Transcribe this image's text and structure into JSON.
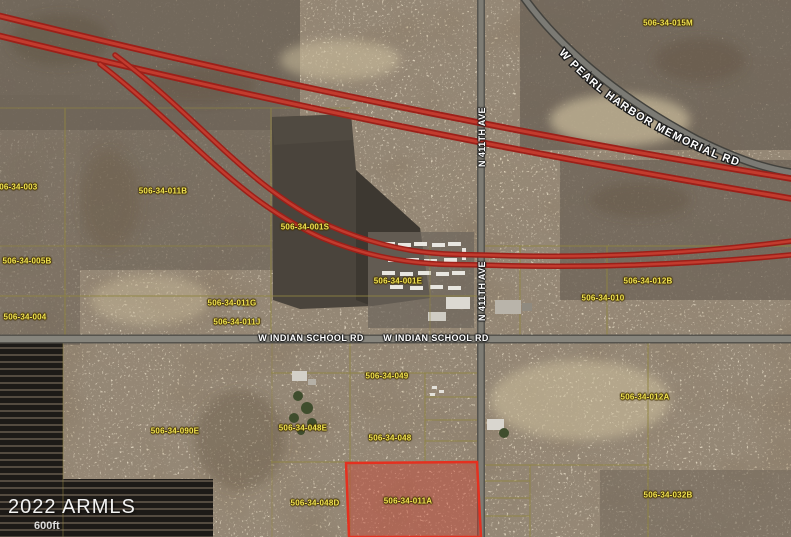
{
  "map": {
    "watermark": "2022 ARMLS",
    "scale_label": "600ft",
    "road_labels": {
      "pearl_harbor": "W PEARL HARBOR MEMORIAL RD",
      "n411_upper": "N 411TH AVE",
      "n411_lower": "N 411TH AVE",
      "indian_school_left": "W INDIAN SCHOOL RD",
      "indian_school_right": "W INDIAN SCHOOL RD"
    },
    "highlight_parcel": {
      "apn": "506-34-011A",
      "outline_color": "#e5301f",
      "fill_color": "#cf4030"
    },
    "parcel_labels": [
      {
        "apn": "506-34-015M"
      },
      {
        "apn": "506-34-003"
      },
      {
        "apn": "506-34-011B"
      },
      {
        "apn": "506-34-001S"
      },
      {
        "apn": "506-34-005B"
      },
      {
        "apn": "506-34-001E"
      },
      {
        "apn": "506-34-011G"
      },
      {
        "apn": "506-34-012B"
      },
      {
        "apn": "506-34-010"
      },
      {
        "apn": "506-34-004"
      },
      {
        "apn": "506-34-011J"
      },
      {
        "apn": "506-34-049"
      },
      {
        "apn": "506-34-012A"
      },
      {
        "apn": "506-34-090E"
      },
      {
        "apn": "506-34-048E"
      },
      {
        "apn": "506-34-048"
      },
      {
        "apn": "506-34-048D"
      },
      {
        "apn": "506-34-032B"
      }
    ],
    "colors": {
      "parcel_label": "#f0e351",
      "parcel_line": "#8f8440",
      "highway": "#c23b2e",
      "road": "#7e7c74",
      "desert": "#c9b795"
    }
  }
}
